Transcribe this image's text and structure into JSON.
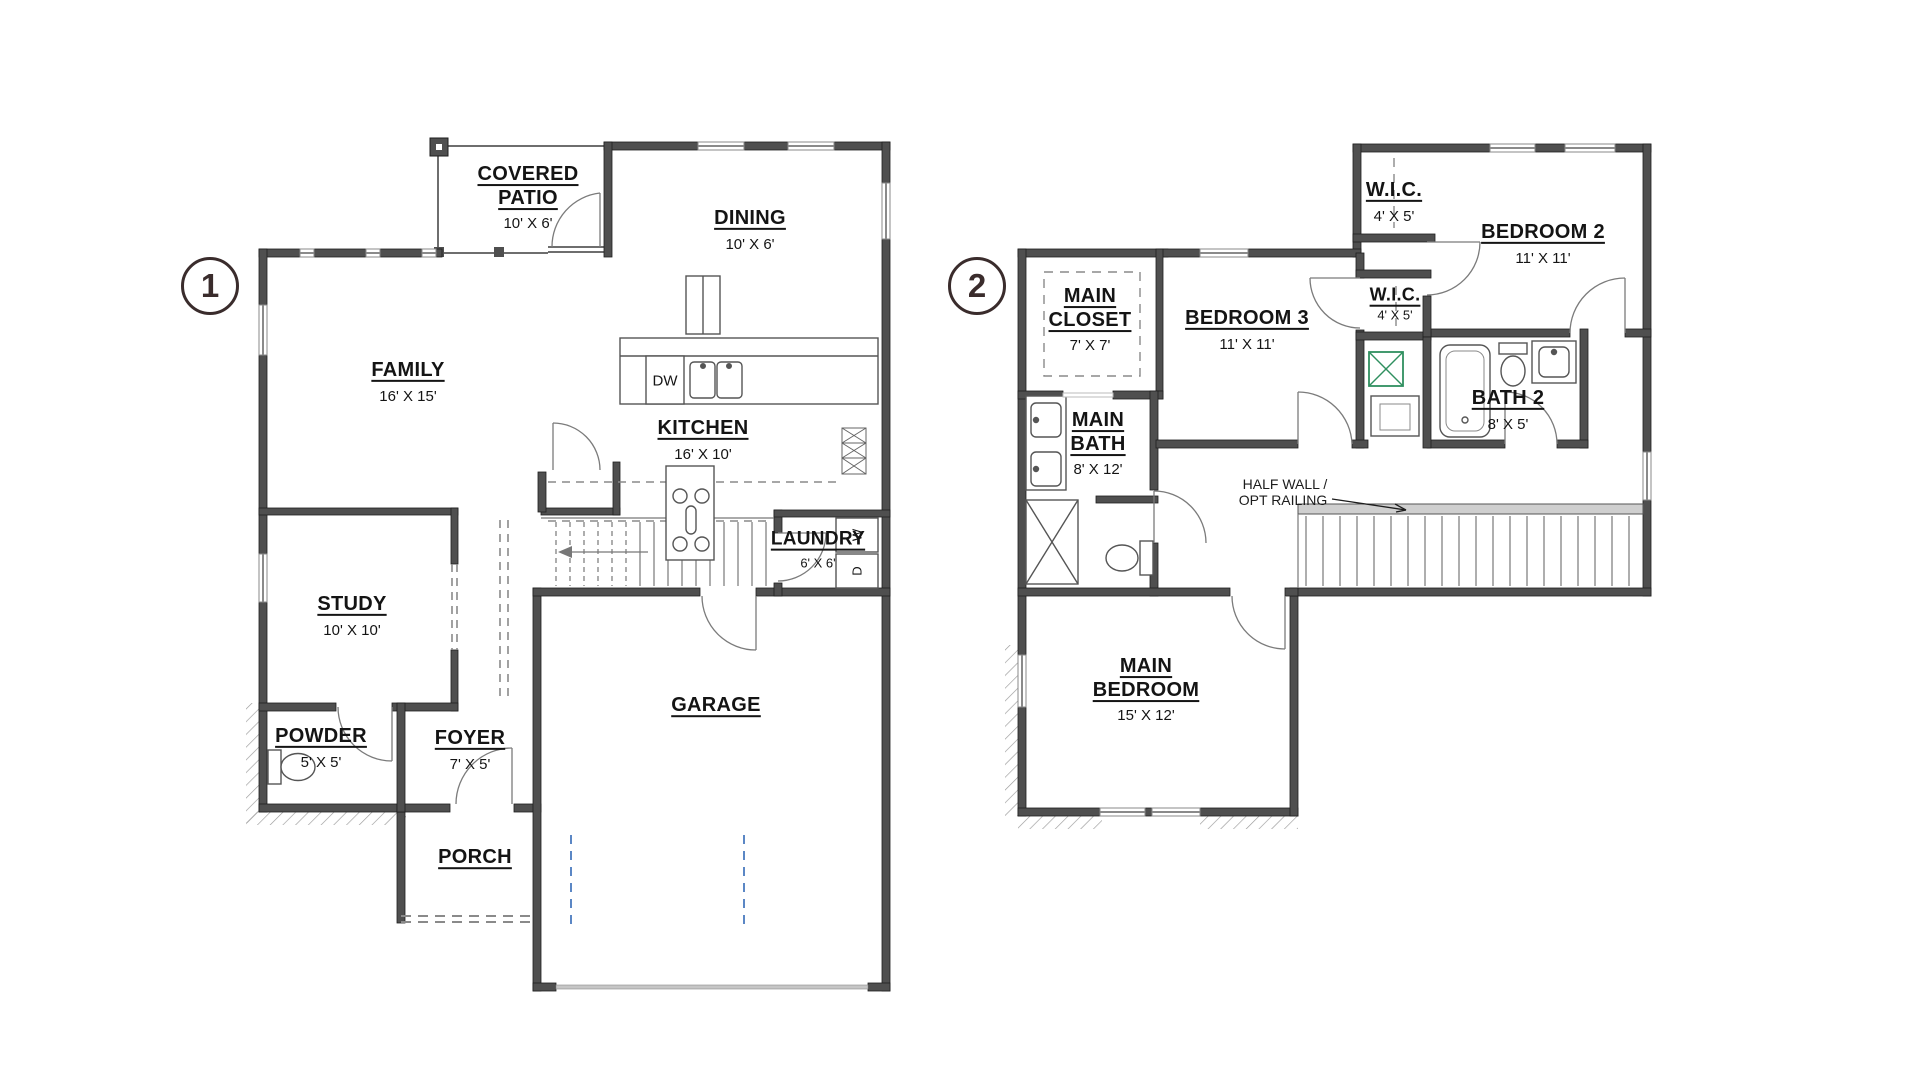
{
  "colors": {
    "wall": "#4f4f4f",
    "wall_outline": "#1e1e1e",
    "text": "#141414",
    "circle_accent": "#3a2c2c",
    "fixture_line": "#555555",
    "dashed_line": "#8a8a8a",
    "garage_opt_blue": "#5b87c5",
    "shelf_green": "#2f8f5f"
  },
  "plans": [
    {
      "number": "1",
      "rooms": [
        {
          "name": "COVERED PATIO",
          "dims": "10' X 6'"
        },
        {
          "name": "DINING",
          "dims": "10' X 6'"
        },
        {
          "name": "FAMILY",
          "dims": "16' X 15'"
        },
        {
          "name": "KITCHEN",
          "dims": "16' X 10'"
        },
        {
          "name": "LAUNDRY",
          "dims": "6' X 6'"
        },
        {
          "name": "STUDY",
          "dims": "10' X 10'"
        },
        {
          "name": "POWDER",
          "dims": "5' X 5'"
        },
        {
          "name": "FOYER",
          "dims": "7' X 5'"
        },
        {
          "name": "PORCH",
          "dims": ""
        },
        {
          "name": "GARAGE",
          "dims": ""
        }
      ],
      "appliances": {
        "dishwasher": "DW",
        "washer": "W",
        "dryer": "D"
      }
    },
    {
      "number": "2",
      "rooms": [
        {
          "name": "W.I.C.",
          "dims": "4' X 5'"
        },
        {
          "name": "BEDROOM 2",
          "dims": "11' X 11'"
        },
        {
          "name": "MAIN CLOSET",
          "dims": "7' X 7'"
        },
        {
          "name": "BEDROOM 3",
          "dims": "11' X 11'"
        },
        {
          "name": "W.I.C.",
          "dims": "4' X 5'"
        },
        {
          "name": "BATH 2",
          "dims": "8' X 5'"
        },
        {
          "name": "MAIN BATH",
          "dims": "8' X 12'"
        },
        {
          "name": "MAIN BEDROOM",
          "dims": "15' X 12'"
        }
      ],
      "annotations": {
        "half_wall_line1": "HALF WALL /",
        "half_wall_line2": "OPT RAILING"
      }
    }
  ]
}
